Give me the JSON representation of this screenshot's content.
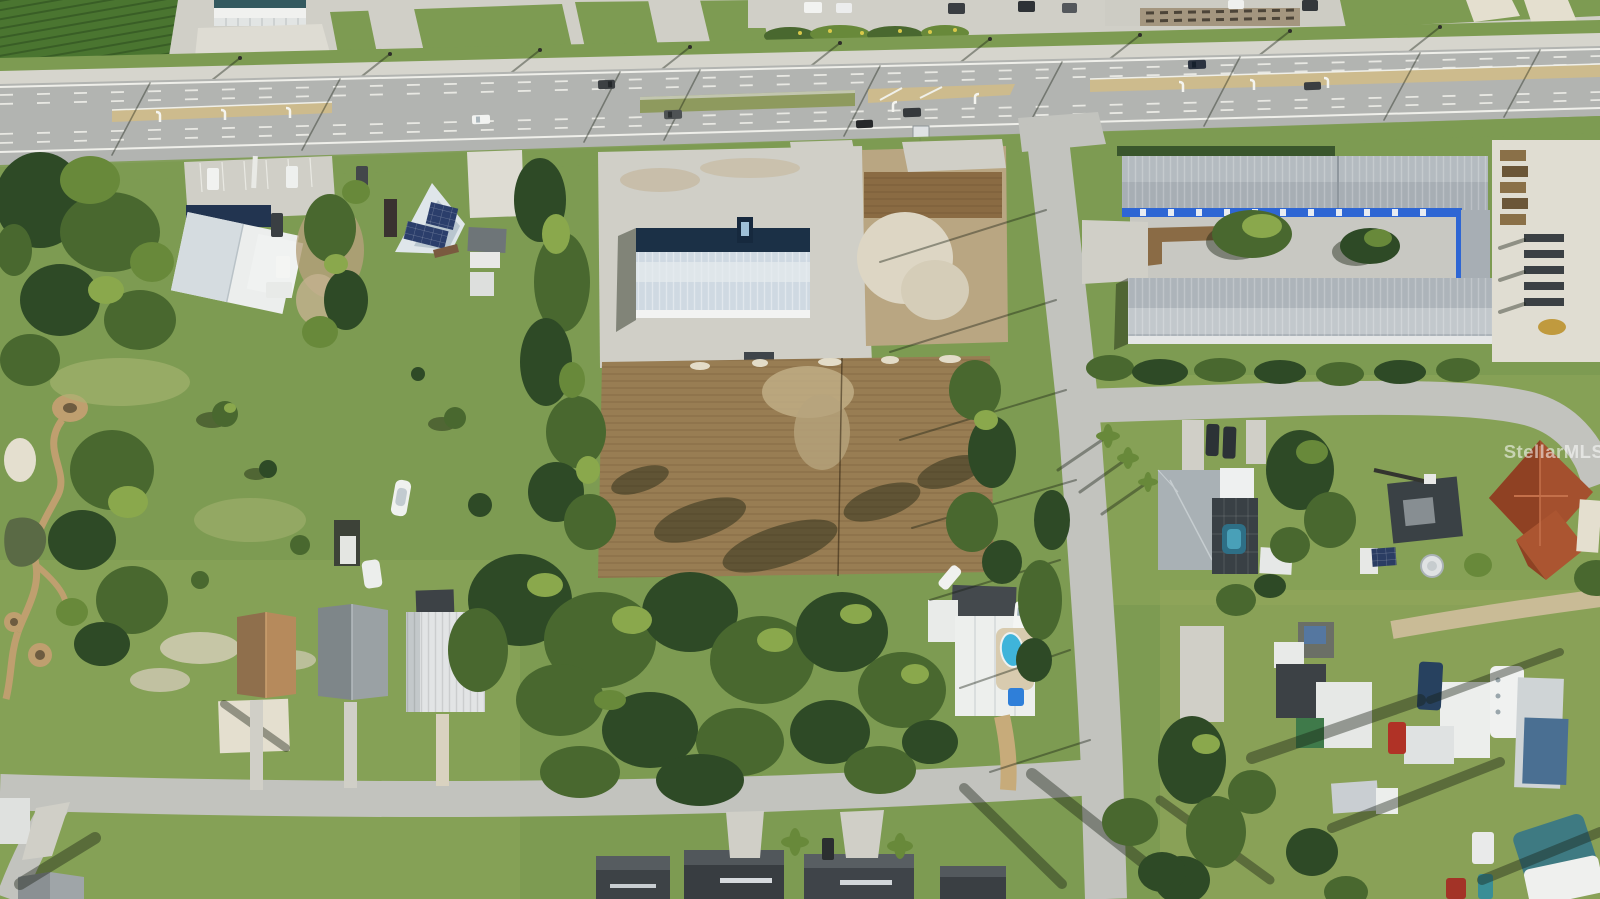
{
  "watermark": {
    "text": "StellarMLS",
    "color": "#ffffff",
    "opacity": "0.55"
  },
  "palette": {
    "grass": "#7d9b52",
    "grassLight": "#97ad66",
    "grassDark": "#668544",
    "grassPale": "#a9b573",
    "highway": "#b2b4b1",
    "road": "#c2c3be",
    "sidewalk": "#d6d5cd",
    "concrete": "#d0cfc7",
    "padBright": "#dedcd3",
    "sand": "#e4dfcf",
    "dirt": "#987d53",
    "dirtDark": "#7c5f3a",
    "dirtLight": "#bba887",
    "medianTan": "#cdbb8d",
    "treeDark": "#2e4a26",
    "treeMid": "#49682f",
    "treeLight": "#68893a",
    "treeBright": "#8aa84c",
    "pathTan": "#bf9f6f",
    "pond": "#5a6a45",
    "roofWhite": "#eceeed",
    "roofBlueWhite": "#cfd9e2",
    "roofShadowNavy": "#1b3046",
    "roofGray": "#a7aeb4",
    "roofCharcoal": "#3e4347",
    "roofBrown": "#a97c55",
    "roofRed": "#a4502e",
    "roofTeal": "#33595f",
    "roofNavy": "#223450",
    "stripeBlue": "#2e66d4",
    "solarPanel": "#2b3e6b",
    "pool": "#3fb4da",
    "spa": "#2f7fd9",
    "shadow": "rgba(18,28,12,0.42)",
    "shadowLine": "rgba(22,30,18,0.40)"
  },
  "scene": {
    "type": "aerial-drone-photo",
    "features": [
      "divided-highway",
      "turn-lane-medians",
      "highway-vehicles",
      "commercial-frontage",
      "church-building",
      "solar-roof-building",
      "warehouse-building",
      "concrete-pad",
      "vacant-dirt-lot",
      "industrial-storage-complex",
      "materials-yard",
      "side-street",
      "bottom-street",
      "right-street",
      "park-trail",
      "pond",
      "residential-houses-row",
      "dark-roof-houses-row",
      "pool-house",
      "screened-pool-house",
      "red-roof-house",
      "homestead-parcel",
      "mobile-home-park",
      "forest-stand",
      "boat-on-lawn",
      "mls-watermark"
    ]
  }
}
